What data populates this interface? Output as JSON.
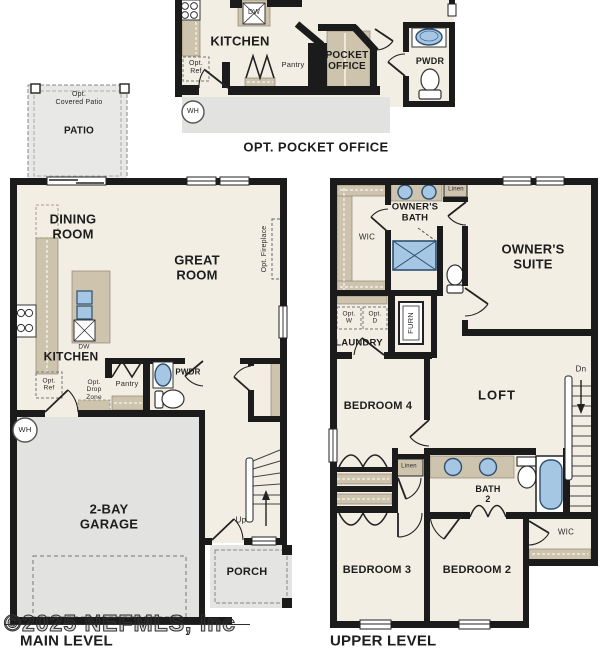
{
  "inset": {
    "labels": {
      "kitchen": "KITCHEN",
      "dw": "DW",
      "opt_ref": "Opt.\nRef",
      "pantry": "Pantry",
      "pocket_office": "POCKET\nOFFICE",
      "pwdr": "PWDR",
      "wh": "WH"
    },
    "caption": "OPT. POCKET OFFICE"
  },
  "main_level": {
    "labels": {
      "opt_covered_patio": "Opt.\nCovered Patio",
      "patio": "PATIO",
      "dining_room": "DINING\nROOM",
      "great_room": "GREAT\nROOM",
      "kitchen": "KITCHEN",
      "opt_fireplace": "Opt. Fireplace",
      "opt_ref": "Opt.\nRef",
      "dw": "DW",
      "pantry": "Pantry",
      "opt_drop_zone": "Opt.\nDrop\nZone",
      "pwdr": "PWDR",
      "wh": "WH",
      "garage": "2-BAY\nGARAGE",
      "up": "Up",
      "porch": "PORCH"
    },
    "caption": "MAIN LEVEL"
  },
  "upper_level": {
    "labels": {
      "wic": "WIC",
      "owners_bath": "OWNER'S\nBATH",
      "linen_top": "Linen",
      "owners_suite": "OWNER'S\nSUITE",
      "furn": "FURN",
      "opt_w": "Opt.\nW",
      "opt_d": "Opt.\nD",
      "laundry": "LAUNDRY",
      "bedroom4": "BEDROOM 4",
      "loft": "LOFT",
      "dn": "Dn",
      "linen_mid": "Linen",
      "bath2": "BATH\n2",
      "bedroom3": "BEDROOM 3",
      "bedroom2": "BEDROOM 2",
      "wic2": "WIC"
    },
    "caption": "UPPER LEVEL"
  },
  "watermark": "©2025 NEFMLS, Inc",
  "colors": {
    "wall": "#1b1b1b",
    "floor": "#f3eee3",
    "cabinetry": "#cec4ae",
    "concrete": "#e4e4e2",
    "fixture_blue": "#a5c7e3"
  }
}
